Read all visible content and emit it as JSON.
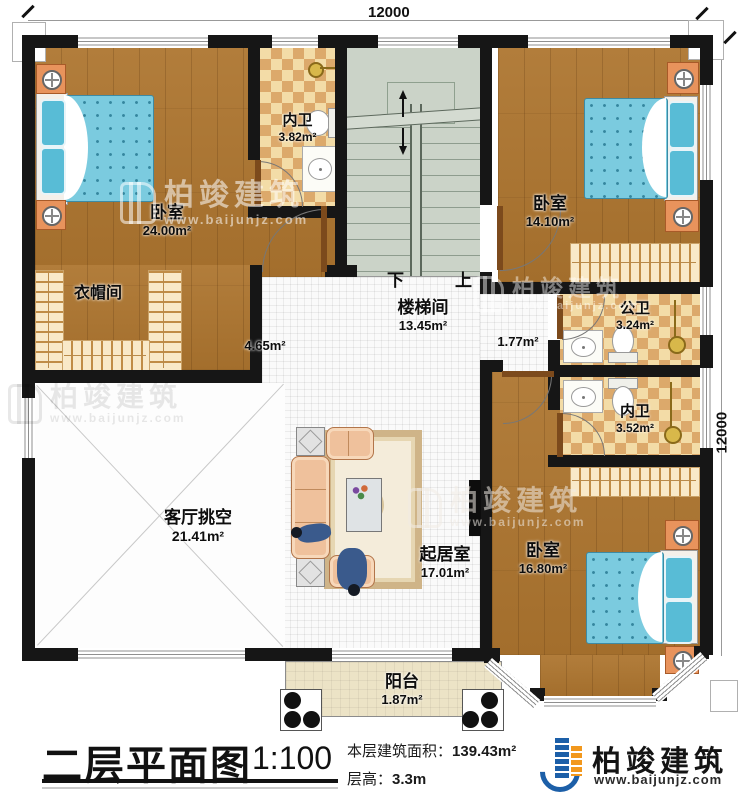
{
  "dimensions": {
    "top": "12000",
    "right": "12000"
  },
  "stairs": {
    "down": "下",
    "up": "上"
  },
  "rooms": {
    "bedroom_tl": {
      "name": "卧室",
      "area": "24.00m²"
    },
    "bath_top": {
      "name": "内卫",
      "area": "3.82m²"
    },
    "stairwell": {
      "name": "楼梯间",
      "area": "13.45m²"
    },
    "bedroom_tr": {
      "name": "卧室",
      "area": "14.10m²"
    },
    "closet": {
      "name": "衣帽间"
    },
    "hall_left": {
      "area": "4.65m²"
    },
    "hall_right": {
      "area": "1.77m²"
    },
    "bath_public": {
      "name": "公卫",
      "area": "3.24m²"
    },
    "bath_right": {
      "name": "内卫",
      "area": "3.52m²"
    },
    "void": {
      "name": "客厅挑空",
      "area": "21.41m²"
    },
    "family": {
      "name": "起居室",
      "area": "17.01m²"
    },
    "bedroom_br": {
      "name": "卧室",
      "area": "16.80m²"
    },
    "balcony": {
      "name": "阳台",
      "area": "1.87m²"
    }
  },
  "title_block": {
    "plan_title": "二层平面图",
    "scale": "1:100",
    "area_label": "本层建筑面积：",
    "area_value": "139.43m²",
    "height_label": "层高：",
    "height_value": "3.3m"
  },
  "brand": {
    "name": "柏竣建筑",
    "website": "www.baijunjz.com"
  },
  "watermark": {
    "name": "柏竣建筑",
    "site": "www.baijunjz.com"
  },
  "colors": {
    "wall": "#161616",
    "wood": "#ad752f",
    "checker": "#dca96b",
    "stair": "#cbd3c8",
    "accent_blue": "#1c5fa8",
    "accent_orange": "#f2981d"
  }
}
